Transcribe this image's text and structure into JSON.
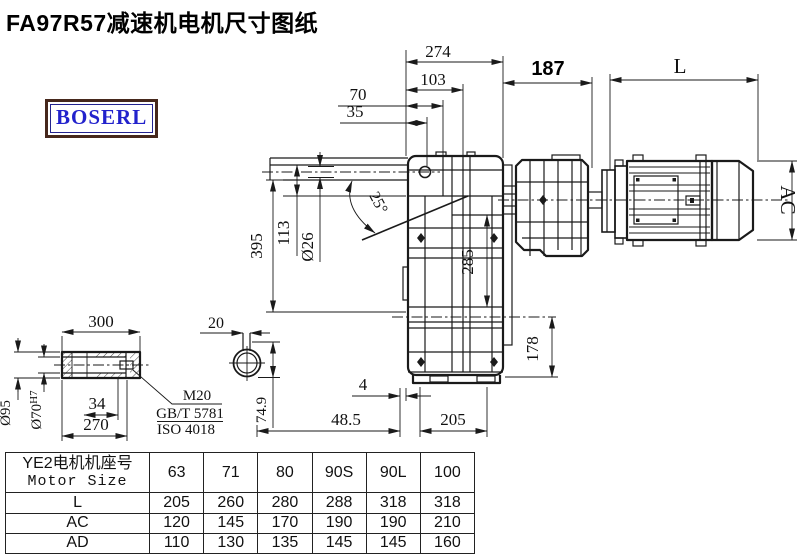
{
  "title": "FA97R57减速机电机尺寸图纸",
  "logo": "BOSERL",
  "drawing": {
    "dims": {
      "top_overall": "274",
      "top_inner": "103",
      "dim_70": "70",
      "dim_35": "35",
      "motor_offset": "187",
      "motor_len": "L",
      "motor_dia": "AC",
      "overall_height": "395",
      "dim_113": "113",
      "hole_dia": "Ø26",
      "angle": "25°",
      "center_height": "285",
      "base_height": "178",
      "gap_4": "4",
      "offset_48_5": "48.5",
      "base_width": "205"
    },
    "shaft": {
      "length": "300",
      "outer_dia": "Ø95",
      "bore_dia": "Ø70",
      "bore_fit": "H7",
      "key_len": "34",
      "bore_len": "270",
      "thread": "M20",
      "std_gb": "GB/T 5781",
      "std_iso": "ISO 4018"
    },
    "section": {
      "key_width": "20",
      "depth": "74.9"
    }
  },
  "table": {
    "header_line1": "YE2电机机座号",
    "header_line2": "Motor Size",
    "sizes": [
      "63",
      "71",
      "80",
      "90S",
      "90L",
      "100"
    ],
    "rows": [
      {
        "label": "L",
        "values": [
          "205",
          "260",
          "280",
          "288",
          "318",
          "318"
        ]
      },
      {
        "label": "AC",
        "values": [
          "120",
          "145",
          "170",
          "190",
          "190",
          "210"
        ]
      },
      {
        "label": "AD",
        "values": [
          "110",
          "130",
          "135",
          "145",
          "145",
          "160"
        ]
      }
    ]
  }
}
